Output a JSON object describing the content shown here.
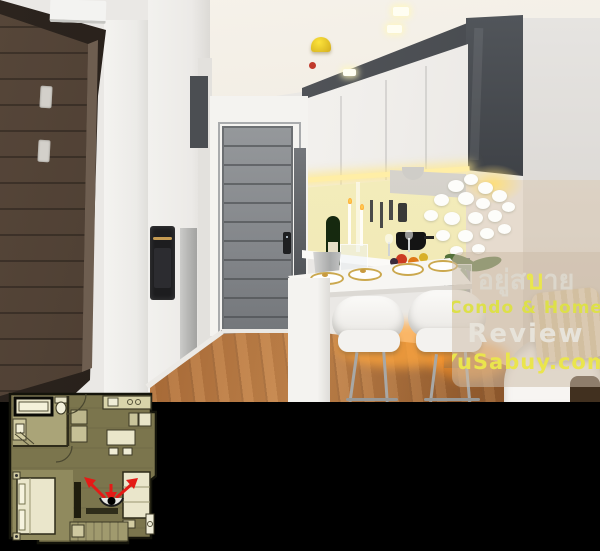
{
  "watermark": {
    "brand_thai": {
      "prefix": "อยู่ส",
      "highlight": "บ",
      "suffix": "าย"
    },
    "tagline": "Condo & Home",
    "review": "Review",
    "website": "YuSabuy.com",
    "colors": {
      "brand_yellow": "#e9e54d",
      "tagline_yellow_green": "#dde049",
      "text_light": "#e7e3da",
      "panel_beige": "rgba(206,190,170,0.55)"
    }
  },
  "floor_plan": {
    "marker": "camera-position-marker",
    "arrow_color": "#e41b16",
    "plan_background": "#7b754d"
  },
  "photo_colors": {
    "wood_floor": "#b06f3a",
    "entrance_door_gray": "#85888b",
    "cabinet_dark_gray": "#3a3d42",
    "under_cabinet_light": "#ffeea6"
  }
}
